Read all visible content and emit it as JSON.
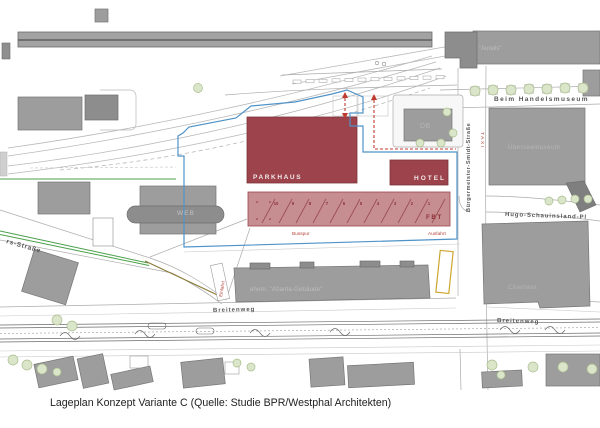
{
  "caption": "Lageplan Konzept Variante C (Quelle: Studie BPR/Westphal Architekten)",
  "plan": {
    "buildings": {
      "parkhaus": "PARKHAUS",
      "hotel": "HOTEL",
      "fbt": "FBT",
      "web": "WEB",
      "db": "DB",
      "aurelis": "\"Aurelis\"",
      "ueberseemuseum": "Überseemuseum",
      "cinemaxx": "Cinemaxx",
      "atlanta": "ehem. \"Atlanta-Gebäude\""
    },
    "streets": {
      "beim_handelsmuseum": "Beim Handelsmuseum",
      "buergermeister_smidt_strasse": "Bürgermeister-Smidt-Straße",
      "hugo_schauinsland": "Hugo-Schauinsland-Pl",
      "breitenweg_west": "Breitenweg",
      "breitenweg_east": "Breitenweg",
      "nw_strasse": "rs-Straße"
    },
    "annotations": {
      "busspur": "Busspur",
      "ausfahrt": "Ausfahrt",
      "einfahrt": "Einfahrt",
      "taxi": "TAXI",
      "bus_bays": [
        "10",
        "9",
        "8",
        "7",
        "6",
        "5",
        "4",
        "3",
        "2",
        "1"
      ]
    },
    "colors": {
      "building_red": "#9c434b",
      "apron_red": "#c68e91",
      "building_gray": "#9d9d9d",
      "boundary_blue": "#4f93c8",
      "route_red": "#c03a30",
      "green_line": "#4aa04a",
      "olive_line": "#8a7a35",
      "marker_yellow": "#cda52e"
    }
  }
}
